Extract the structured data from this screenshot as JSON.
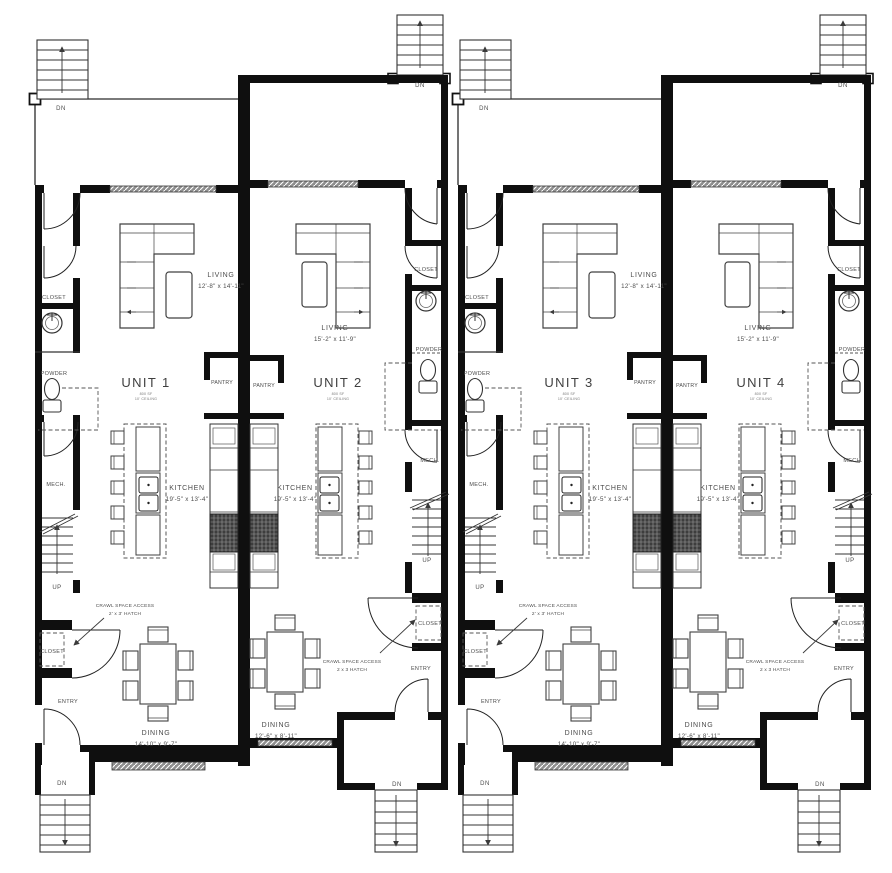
{
  "plan": {
    "shared": {
      "dn": "DN",
      "up": "UP"
    },
    "wall_color": "#0f0f0f",
    "line_color": "#333333",
    "text_color": "#4c4c4c",
    "units": [
      {
        "name": "UNIT 1",
        "area": "800 SF",
        "ceiling": "10' CEILING",
        "living": "LIVING",
        "living_dims": "12'-8\" x 14'-11\"",
        "kitchen": "KITCHEN",
        "kitchen_dims": "19'-5\" x 13'-4\"",
        "dining": "DINING",
        "dining_dims": "14'-10\" x 9'-7\"",
        "closet_upper": "CLOSET",
        "powder": "POWDER",
        "pantry": "PANTRY",
        "mech": "MECH.",
        "closet_lower": "CLOSET",
        "entry": "ENTRY",
        "crawl_line1": "CRAWL SPACE ACCESS",
        "crawl_line2": "2' x 3' HATCH"
      },
      {
        "name": "UNIT 2",
        "area": "800 SF",
        "ceiling": "10' CEILING",
        "living": "LIVING",
        "living_dims": "15'-2\" x 11'-9\"",
        "kitchen": "KITCHEN",
        "kitchen_dims": "19'-5\" x 13'-4\"",
        "dining": "DINING",
        "dining_dims": "12'-6\" x 8'-11\"",
        "closet_upper": "CLOSET",
        "powder": "POWDER",
        "pantry": "PANTRY",
        "mech": "MECH.",
        "closet_lower": "CLOSET",
        "entry": "ENTRY",
        "crawl_line1": "CRAWL SPACE ACCESS",
        "crawl_line2": "2 x 3 HATCH"
      },
      {
        "name": "UNIT 3",
        "area": "800 SF",
        "ceiling": "10' CEILING",
        "living": "LIVING",
        "living_dims": "12'-8\" x 14'-11\"",
        "kitchen": "KITCHEN",
        "kitchen_dims": "19'-5\" x 13'-4\"",
        "dining": "DINING",
        "dining_dims": "14'-10\" x 9'-7\"",
        "closet_upper": "CLOSET",
        "powder": "POWDER",
        "pantry": "PANTRY",
        "mech": "MECH.",
        "closet_lower": "CLOSET",
        "entry": "ENTRY",
        "crawl_line1": "CRAWL SPACE ACCESS",
        "crawl_line2": "2' x 3' HATCH"
      },
      {
        "name": "UNIT 4",
        "area": "800 SF",
        "ceiling": "10' CEILING",
        "living": "LIVING",
        "living_dims": "15'-2\" x 11'-9\"",
        "kitchen": "KITCHEN",
        "kitchen_dims": "19'-5\" x 13'-4\"",
        "dining": "DINING",
        "dining_dims": "12'-6\" x 8'-11\"",
        "closet_upper": "CLOSET",
        "powder": "POWDER",
        "pantry": "PANTRY",
        "mech": "MECH.",
        "closet_lower": "CLOSET",
        "entry": "ENTRY",
        "crawl_line1": "CRAWL SPACE ACCESS",
        "crawl_line2": "2 x 3 HATCH"
      }
    ]
  }
}
